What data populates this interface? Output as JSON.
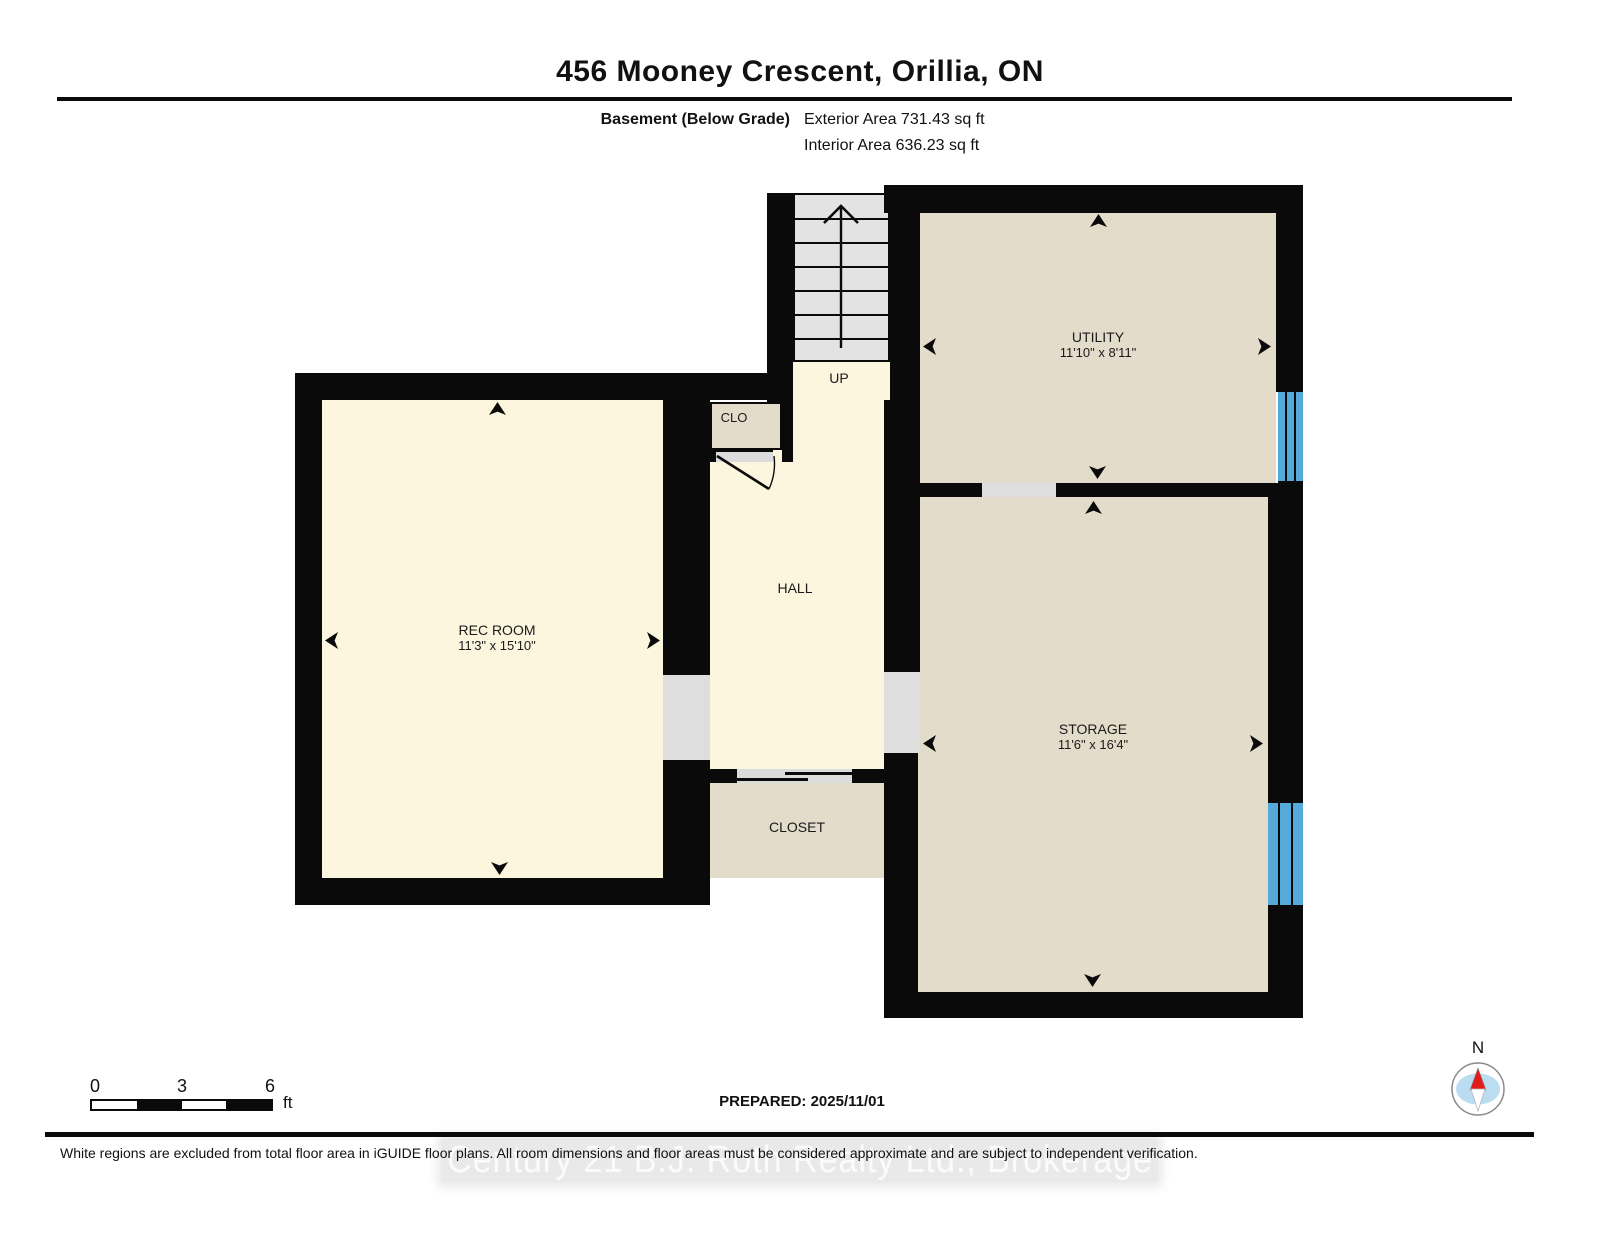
{
  "header": {
    "title": "456 Mooney Crescent, Orillia, ON",
    "floor_label": "Basement (Below Grade)",
    "exterior_area": "Exterior Area 731.43 sq ft",
    "interior_area": "Interior Area 636.23 sq ft"
  },
  "rooms": {
    "rec_room": {
      "name": "REC ROOM",
      "dims": "11'3\" x 15'10\""
    },
    "utility": {
      "name": "UTILITY",
      "dims": "11'10\" x 8'11\""
    },
    "storage": {
      "name": "STORAGE",
      "dims": "11'6\" x 16'4\""
    },
    "hall": {
      "name": "HALL"
    },
    "closet": {
      "name": "CLOSET"
    },
    "clo": {
      "name": "CLO"
    }
  },
  "stairs": {
    "direction_label": "UP"
  },
  "scale_bar": {
    "ticks": [
      "0",
      "3",
      "6"
    ],
    "unit": "ft"
  },
  "compass": {
    "label": "N"
  },
  "footer": {
    "prepared": "PREPARED: 2025/11/01",
    "disclaimer": "White regions are excluded from total floor area in iGUIDE floor plans. All room dimensions and floor areas must be considered approximate and are subject to independent verification.",
    "watermark": "Century 21 B.J. Roth Realty Ltd., Brokerage"
  },
  "colors": {
    "wall": "#0a0a0a",
    "floor_light": "#FCF6DF",
    "floor_dark": "#E4DCCA",
    "opening_gray": "#DEDEDE",
    "stairs_gray": "#E3E3E3",
    "window_blue": "#54AADB",
    "compass_red": "#E31B1C",
    "compass_blue": "#BBDDF1"
  }
}
